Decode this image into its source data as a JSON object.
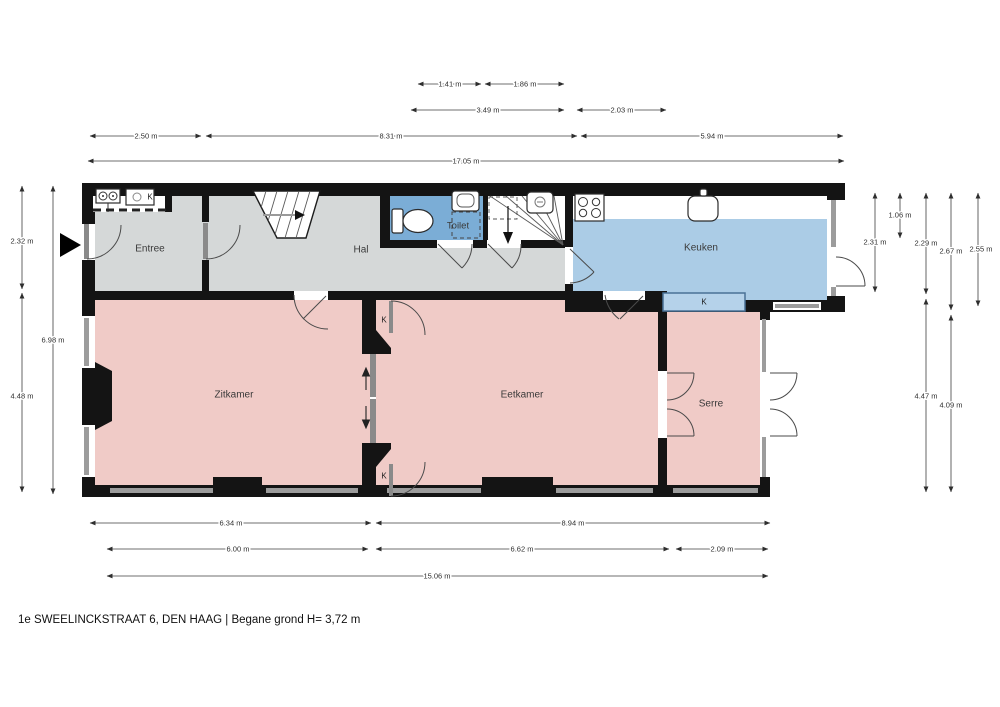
{
  "title": "1e SWEELINCKSTRAAT 6, DEN HAAG | Begane grond H= 3,72 m",
  "rooms": {
    "entree": "Entree",
    "hal": "Hal",
    "toilet": "Toilet",
    "keuken": "Keuken",
    "zitkamer": "Zitkamer",
    "eetkamer": "Eetkamer",
    "serre": "Serre"
  },
  "closet_labels": {
    "meterkast": "K",
    "ensuite_top": "K",
    "ensuite_bottom": "K",
    "keuken_kast": "K"
  },
  "dimensions": {
    "top": [
      "1.41 m",
      "1.86 m",
      "3.49 m",
      "2.03 m",
      "2.50 m",
      "8.31 m",
      "5.94 m",
      "17.05 m"
    ],
    "bottom": [
      "6.34 m",
      "8.94 m",
      "6.00 m",
      "6.62 m",
      "2.09 m",
      "15.06 m"
    ],
    "left": [
      "2.32 m",
      "4.48 m",
      "6.98 m"
    ],
    "right": [
      "2.31 m",
      "1.06 m",
      "2.29 m",
      "4.47 m",
      "2.67 m",
      "4.09 m",
      "2.55 m"
    ]
  },
  "colors": {
    "wall": "#141414",
    "floor_gray": "#d5d8d8",
    "floor_pink": "#f0cbc7",
    "keuken_blue": "#abcce6",
    "toilet_blue": "#7badd6",
    "kast_blue_fill": "#b5d2ea",
    "kast_blue_stroke": "#4a7196",
    "window_gray": "#9c9c9c",
    "dim_line": "#3f3f3f"
  }
}
